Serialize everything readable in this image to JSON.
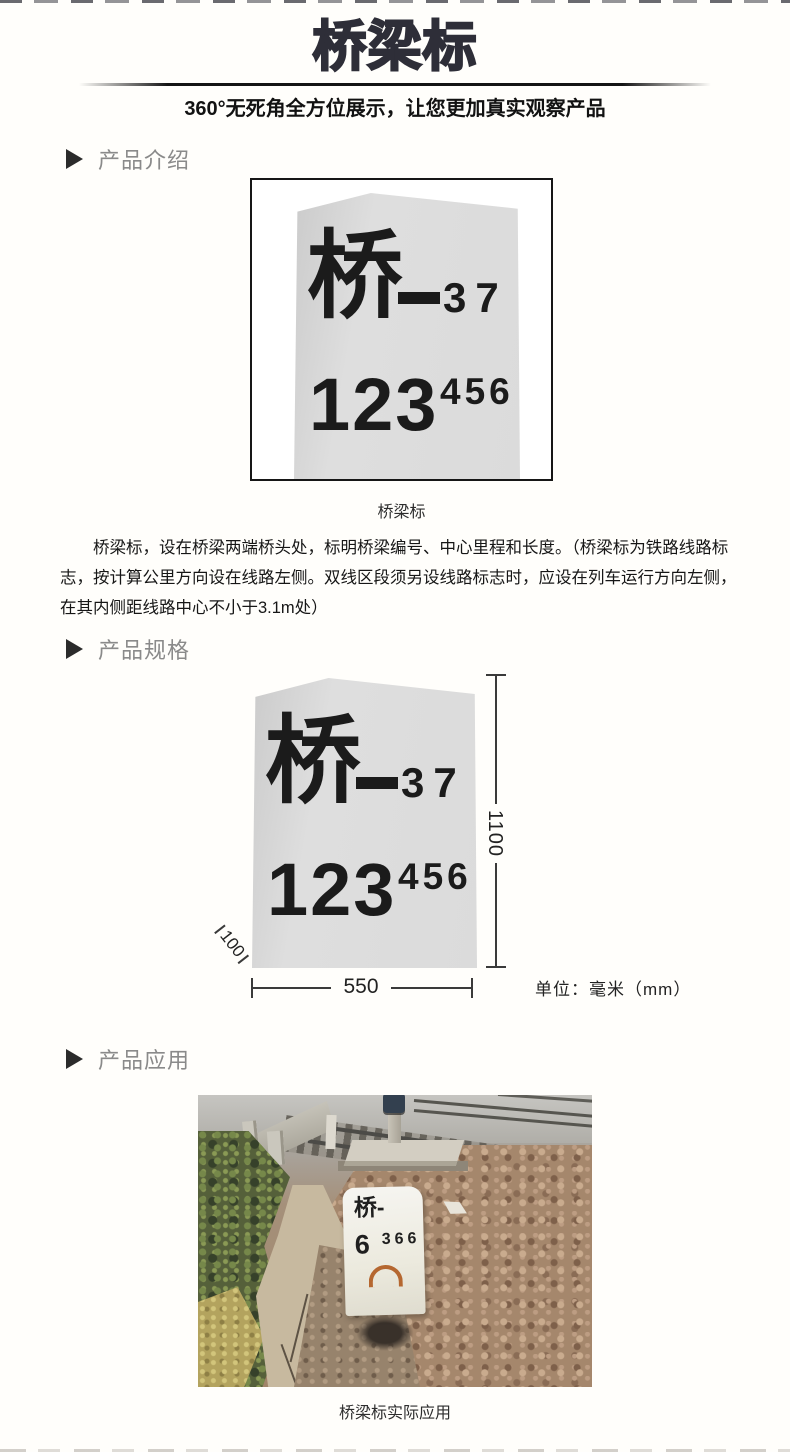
{
  "page": {
    "title": "桥梁标",
    "subtitle": "360°无死角全方位展示，让您更加真实观察产品"
  },
  "sections": {
    "intro": {
      "label": "产品介绍"
    },
    "spec": {
      "label": "产品规格"
    },
    "application": {
      "label": "产品应用"
    }
  },
  "marker_sign": {
    "char": "桥",
    "dash": "—",
    "serial": "37",
    "mileage_main": "123",
    "mileage_sup": "456"
  },
  "figure_intro": {
    "caption": "桥梁标"
  },
  "description": {
    "lines": [
      "桥梁标，设在桥梁两端桥头处，标明桥梁编号、中心里程和长度。（桥梁标为铁路线路标",
      "志，按计算公里方向设在线路左侧。双线区段须另设线路标志时，应设在列车运行方向左侧，",
      "在其内侧距线路中心不小于3.1m处）"
    ]
  },
  "spec_figure": {
    "height_mm": "1100",
    "width_mm": "550",
    "base_offset_mm": "100",
    "unit_note": "单位：毫米（mm）"
  },
  "photo": {
    "stone_text_line1": "桥-",
    "stone_text_main": "6",
    "stone_text_sub": "366",
    "caption": "桥梁标实际应用"
  },
  "colors": {
    "title_ink": "#2e2e38",
    "section_label": "#8a8a8a",
    "stone_fill": "#dcdcdc",
    "ink": "#1a1a1a",
    "rust": "#b05a1e"
  }
}
